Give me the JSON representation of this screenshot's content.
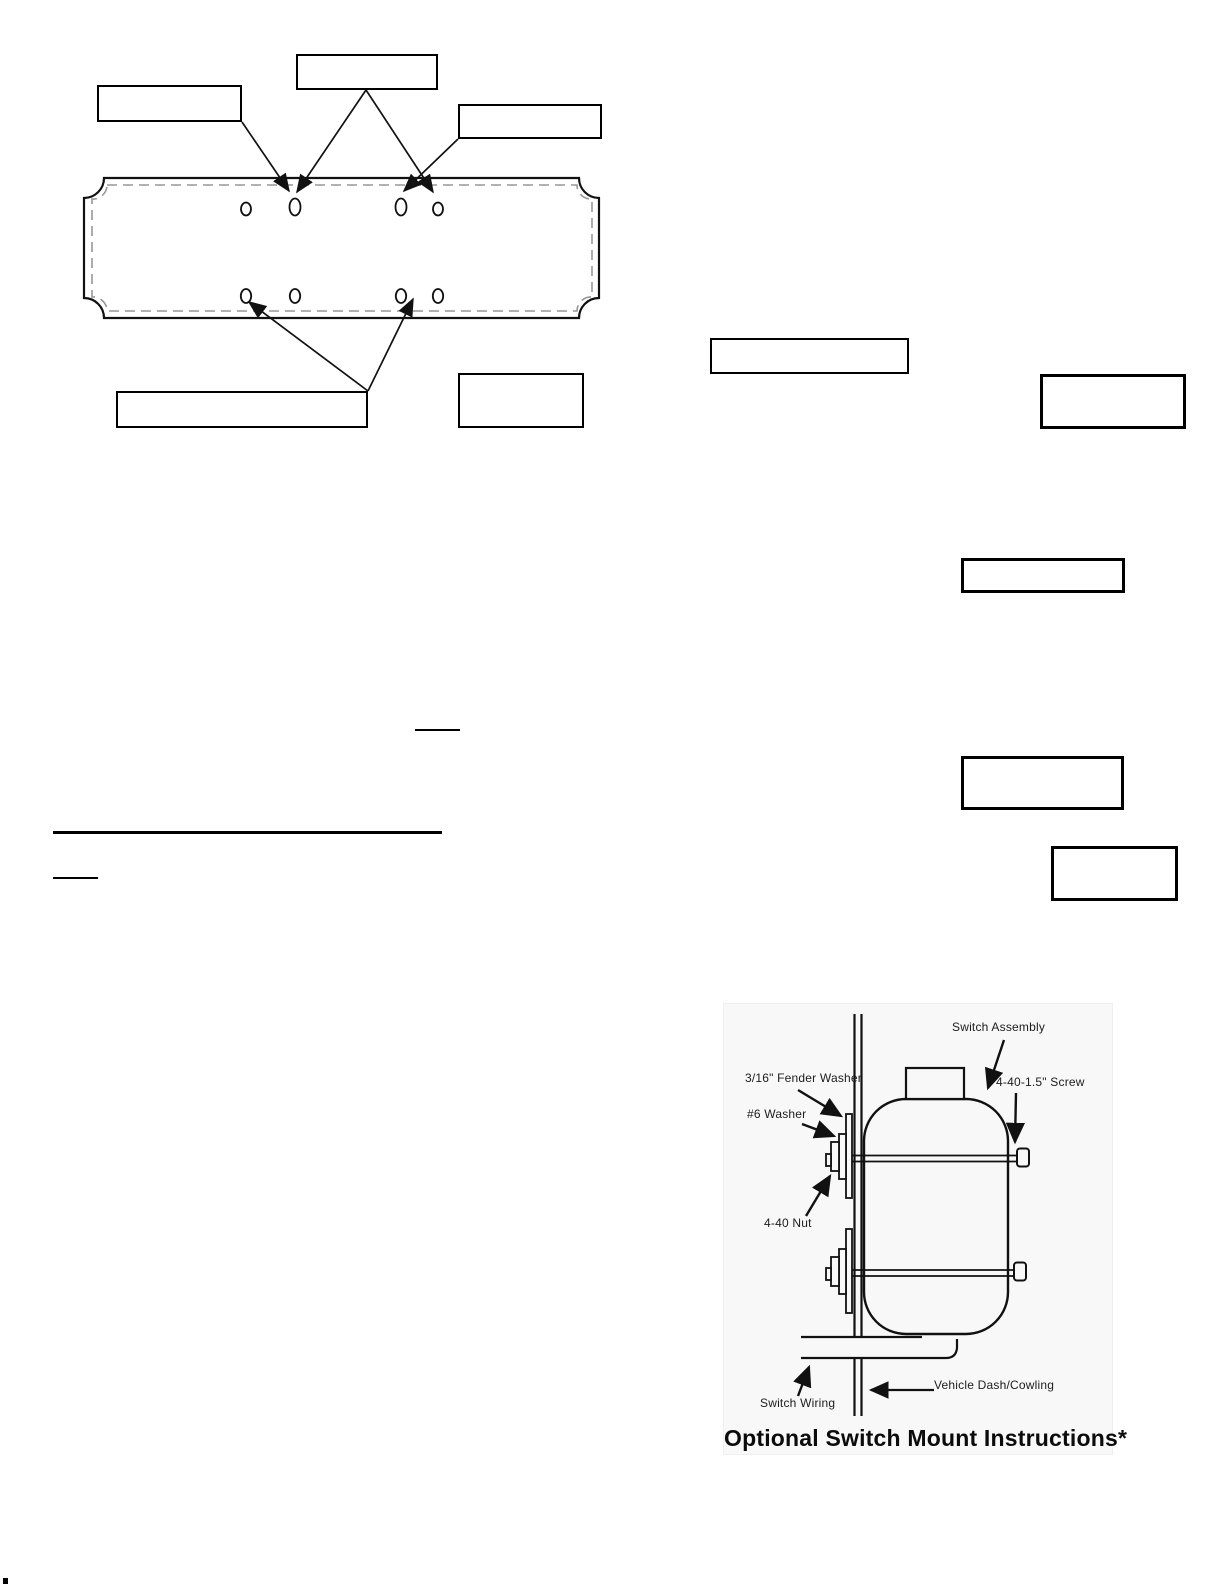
{
  "page": {
    "background": "#ffffff"
  },
  "plate_figure": {
    "description": "mounting plate template with eight slotted holes and five empty callout boxes",
    "callout_boxes_text": [
      "",
      "",
      "",
      "",
      ""
    ],
    "line_color": "#111111",
    "dash_color": "#979797"
  },
  "blanks": {
    "count": 3
  },
  "side_boxes_text": [
    "",
    "",
    "",
    "",
    ""
  ],
  "switch_diagram": {
    "background": "#f8f8f8",
    "labels": {
      "switch_assembly": "Switch Assembly",
      "fender_washer": "3/16\" Fender Washer",
      "number6_washer": "#6 Washer",
      "nut": "4-40 Nut",
      "screw": "4-40-1.5\" Screw",
      "dash_cowling": "Vehicle Dash/Cowling",
      "switch_wiring": "Switch Wiring"
    },
    "caption": "Optional Switch Mount Instructions*"
  }
}
